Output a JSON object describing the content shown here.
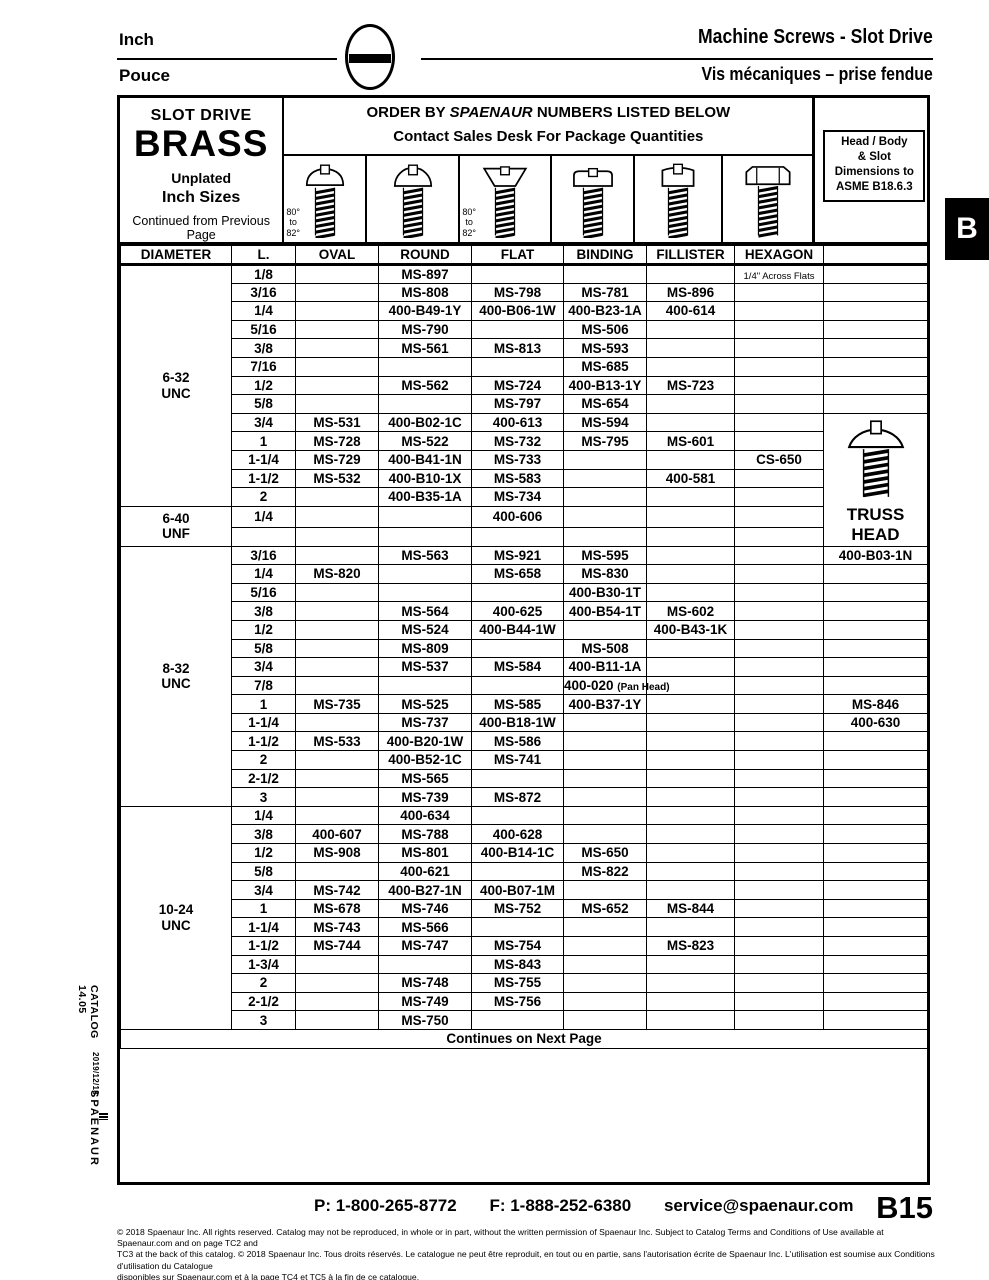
{
  "page_header": {
    "lang_top": "Inch",
    "lang_bottom": "Pouce",
    "title_en": "Machine Screws - Slot Drive",
    "title_fr": "Vis mécaniques – prise fendue"
  },
  "side": {
    "catalog": "CATALOG 14.05",
    "date": "2019/12/18",
    "brand": "SPAENAUR",
    "tab": "B"
  },
  "table_header": {
    "slot_drive": "SLOT DRIVE",
    "material": "BRASS",
    "finish": "Unplated",
    "sizes": "Inch Sizes",
    "continued": "Continued from Previous Page",
    "order_prefix": "ORDER BY ",
    "order_brand": "SPAENAUR",
    "order_suffix": " NUMBERS LISTED BELOW",
    "order_line2": "Contact Sales Desk For Package Quantities",
    "asme_note": "Head / Body\n& Slot\nDimensions to\nASME B18.6.3",
    "angle_note": "80°\nto\n82°"
  },
  "icons": [
    {
      "name": "oval-head-screw-icon",
      "type": "oval",
      "angle_note": true
    },
    {
      "name": "round-head-screw-icon",
      "type": "round",
      "angle_note": false
    },
    {
      "name": "flat-head-screw-icon",
      "type": "flat",
      "angle_note": true
    },
    {
      "name": "binding-head-screw-icon",
      "type": "binding",
      "angle_note": false
    },
    {
      "name": "fillister-head-screw-icon",
      "type": "fillister",
      "angle_note": false
    },
    {
      "name": "hexagon-head-screw-icon",
      "type": "hexagon",
      "angle_note": false
    }
  ],
  "columns": [
    "DIAMETER",
    "L.",
    "OVAL",
    "ROUND",
    "FLAT",
    "BINDING",
    "FILLISTER",
    "HEXAGON",
    ""
  ],
  "truss_panel": {
    "label": "TRUSS\nHEAD",
    "rowspan": 7
  },
  "sections": [
    {
      "label": "6-32\nUNC",
      "rows": [
        [
          "1/8",
          "",
          "MS-897",
          "",
          "",
          "",
          "~1/4\" Across Flats",
          ""
        ],
        [
          "3/16",
          "",
          "MS-808",
          "MS-798",
          "MS-781",
          "MS-896",
          "",
          ""
        ],
        [
          "1/4",
          "",
          "400-B49-1Y",
          "400-B06-1W",
          "400-B23-1A",
          "400-614",
          "",
          ""
        ],
        [
          "5/16",
          "",
          "MS-790",
          "",
          "MS-506",
          "",
          "",
          ""
        ],
        [
          "3/8",
          "",
          "MS-561",
          "MS-813",
          "MS-593",
          "",
          "",
          ""
        ],
        [
          "7/16",
          "",
          "",
          "",
          "MS-685",
          "",
          "",
          ""
        ],
        [
          "1/2",
          "",
          "MS-562",
          "MS-724",
          "400-B13-1Y",
          "MS-723",
          "",
          ""
        ],
        [
          "5/8",
          "",
          "",
          "MS-797",
          "MS-654",
          "",
          "",
          ""
        ],
        [
          "3/4",
          "MS-531",
          "400-B02-1C",
          "400-613",
          "MS-594",
          "",
          "",
          "@PANEL"
        ],
        [
          "1",
          "MS-728",
          "MS-522",
          "MS-732",
          "MS-795",
          "MS-601",
          "",
          "@SKIP"
        ],
        [
          "1-1/4",
          "MS-729",
          "400-B41-1N",
          "MS-733",
          "",
          "",
          "CS-650",
          "@SKIP"
        ],
        [
          "1-1/2",
          "MS-532",
          "400-B10-1X",
          "MS-583",
          "",
          "400-581",
          "",
          "@SKIP"
        ],
        [
          "2",
          "",
          "400-B35-1A",
          "MS-734",
          "",
          "",
          "",
          "@SKIP"
        ]
      ]
    },
    {
      "label": "6-40\nUNF",
      "rows": [
        [
          "1/4",
          "",
          "",
          "400-606",
          "",
          "",
          "",
          "@SKIP"
        ],
        [
          "",
          "",
          "",
          "",
          "",
          "",
          "",
          "@SKIP"
        ]
      ]
    },
    {
      "label": "8-32\nUNC",
      "rows": [
        [
          "3/16",
          "",
          "MS-563",
          "MS-921",
          "MS-595",
          "",
          "",
          "400-B03-1N"
        ],
        [
          "1/4",
          "MS-820",
          "",
          "MS-658",
          "MS-830",
          "",
          "",
          ""
        ],
        [
          "5/16",
          "",
          "",
          "",
          "400-B30-1T",
          "",
          "",
          ""
        ],
        [
          "3/8",
          "",
          "MS-564",
          "400-625",
          "400-B54-1T",
          "MS-602",
          "",
          ""
        ],
        [
          "1/2",
          "",
          "MS-524",
          "400-B44-1W",
          "",
          "400-B43-1K",
          "",
          ""
        ],
        [
          "5/8",
          "",
          "MS-809",
          "",
          "MS-508",
          "",
          "",
          ""
        ],
        [
          "3/4",
          "",
          "MS-537",
          "MS-584",
          "400-B11-1A",
          "",
          "",
          ""
        ],
        [
          "7/8",
          "",
          "",
          "",
          "400-020 (Pan Head)",
          "",
          "",
          ""
        ],
        [
          "1",
          "MS-735",
          "MS-525",
          "MS-585",
          "400-B37-1Y",
          "",
          "",
          "MS-846"
        ],
        [
          "1-1/4",
          "",
          "MS-737",
          "400-B18-1W",
          "",
          "",
          "",
          "400-630"
        ],
        [
          "1-1/2",
          "MS-533",
          "400-B20-1W",
          "MS-586",
          "",
          "",
          "",
          ""
        ],
        [
          "2",
          "",
          "400-B52-1C",
          "MS-741",
          "",
          "",
          "",
          ""
        ],
        [
          "2-1/2",
          "",
          "MS-565",
          "",
          "",
          "",
          "",
          ""
        ],
        [
          "3",
          "",
          "MS-739",
          "MS-872",
          "",
          "",
          "",
          ""
        ]
      ]
    },
    {
      "label": "10-24\nUNC",
      "rows": [
        [
          "1/4",
          "",
          "400-634",
          "",
          "",
          "",
          "",
          ""
        ],
        [
          "3/8",
          "400-607",
          "MS-788",
          "400-628",
          "",
          "",
          "",
          ""
        ],
        [
          "1/2",
          "MS-908",
          "MS-801",
          "400-B14-1C",
          "MS-650",
          "",
          "",
          ""
        ],
        [
          "5/8",
          "",
          "400-621",
          "",
          "MS-822",
          "",
          "",
          ""
        ],
        [
          "3/4",
          "MS-742",
          "400-B27-1N",
          "400-B07-1M",
          "",
          "",
          "",
          ""
        ],
        [
          "1",
          "MS-678",
          "MS-746",
          "MS-752",
          "MS-652",
          "MS-844",
          "",
          ""
        ],
        [
          "1-1/4",
          "MS-743",
          "MS-566",
          "",
          "",
          "",
          "",
          ""
        ],
        [
          "1-1/2",
          "MS-744",
          "MS-747",
          "MS-754",
          "",
          "MS-823",
          "",
          ""
        ],
        [
          "1-3/4",
          "",
          "",
          "MS-843",
          "",
          "",
          "",
          ""
        ],
        [
          "2",
          "",
          "MS-748",
          "MS-755",
          "",
          "",
          "",
          ""
        ],
        [
          "2-1/2",
          "",
          "MS-749",
          "MS-756",
          "",
          "",
          "",
          ""
        ],
        [
          "3",
          "",
          "MS-750",
          "",
          "",
          "",
          "",
          ""
        ]
      ]
    }
  ],
  "continues_note": "Continues on Next Page",
  "footer": {
    "phone": "P: 1-800-265-8772",
    "fax": "F: 1-888-252-6380",
    "email": "service@spaenaur.com",
    "page_number": "B15",
    "legal": "© 2018 Spaenaur Inc. All rights reserved. Catalog may not be reproduced, in whole or in part, without the written permission of Spaenaur Inc. Subject to Catalog Terms and Conditions of Use available at Spaenaur.com and on page TC2 and\nTC3 at the back of this catalog. © 2018 Spaenaur Inc. Tous droits réservés. Le catalogue ne peut être reproduit, en tout ou en partie, sans l'autorisation écrite de Spaenaur Inc. L'utilisation est soumise aux Conditions d'utilisation du Catalogue\ndisponibles sur Spaenaur.com et à la page TC4 et TC5 à la fin de ce catalogue."
  }
}
